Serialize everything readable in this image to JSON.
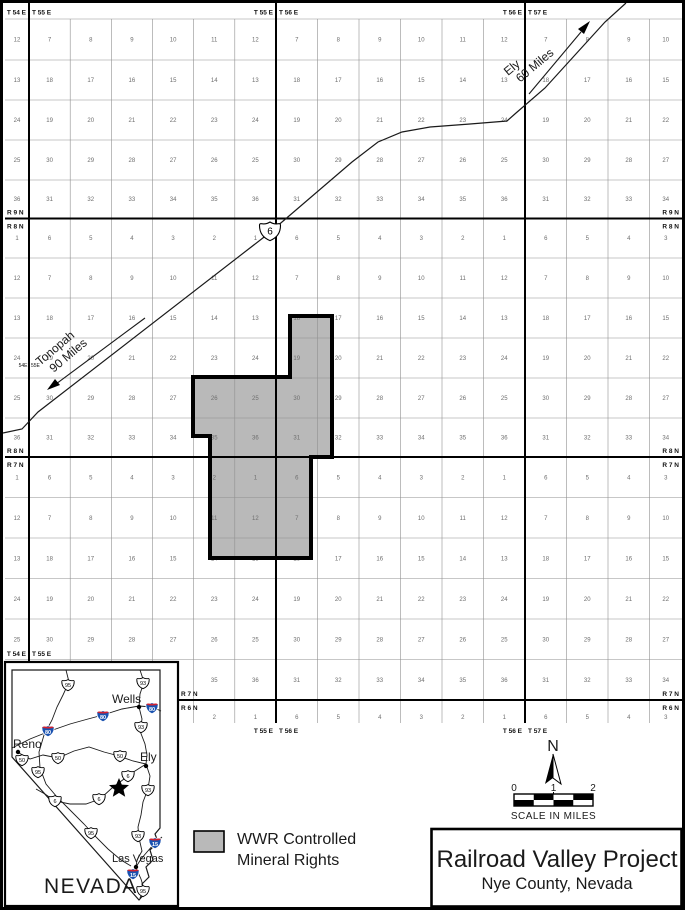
{
  "map": {
    "boundary_label_pairs": [
      [
        "T 54 E",
        "T 55 E"
      ],
      [
        "T 55 E",
        "T 56 E"
      ],
      [
        "T 56 E",
        "T 57 E"
      ]
    ],
    "mid_boundary_label": [
      "54E",
      "55E"
    ],
    "range_boundaries": [
      [
        "R 9 N",
        "R 8 N"
      ],
      [
        "R 8 N",
        "R 7 N"
      ],
      [
        "R 7 N",
        "R 6 N"
      ]
    ],
    "highway_shield": "6",
    "annotations": {
      "ely": {
        "line1": "Ely",
        "line2": "60 Miles"
      },
      "tonopah": {
        "line1": "Tonopah",
        "line2": "90 Miles"
      }
    },
    "bands": [
      {
        "name": "R9N",
        "rows": [
          [
            "12",
            "7",
            "8",
            "9",
            "10",
            "11",
            "12",
            "7",
            "8",
            "9",
            "10",
            "11",
            "12",
            "7",
            "8",
            "9",
            "10"
          ],
          [
            "13",
            "18",
            "17",
            "16",
            "15",
            "14",
            "13",
            "18",
            "17",
            "16",
            "15",
            "14",
            "13",
            "18",
            "17",
            "16",
            "15"
          ],
          [
            "24",
            "19",
            "20",
            "21",
            "22",
            "23",
            "24",
            "19",
            "20",
            "21",
            "22",
            "23",
            "24",
            "19",
            "20",
            "21",
            "22"
          ],
          [
            "25",
            "30",
            "29",
            "28",
            "27",
            "26",
            "25",
            "30",
            "29",
            "28",
            "27",
            "26",
            "25",
            "30",
            "29",
            "28",
            "27"
          ],
          [
            "36",
            "31",
            "32",
            "33",
            "34",
            "35",
            "36",
            "31",
            "32",
            "33",
            "34",
            "35",
            "36",
            "31",
            "32",
            "33",
            "34"
          ]
        ]
      },
      {
        "name": "R8N",
        "rows": [
          [
            "1",
            "6",
            "5",
            "4",
            "3",
            "2",
            "1",
            "6",
            "5",
            "4",
            "3",
            "2",
            "1",
            "6",
            "5",
            "4",
            "3"
          ],
          [
            "12",
            "7",
            "8",
            "9",
            "10",
            "11",
            "12",
            "7",
            "8",
            "9",
            "10",
            "11",
            "12",
            "7",
            "8",
            "9",
            "10"
          ],
          [
            "13",
            "18",
            "17",
            "16",
            "15",
            "14",
            "13",
            "18",
            "17",
            "16",
            "15",
            "14",
            "13",
            "18",
            "17",
            "16",
            "15"
          ],
          [
            "24",
            "19",
            "20",
            "21",
            "22",
            "23",
            "24",
            "19",
            "20",
            "21",
            "22",
            "23",
            "24",
            "19",
            "20",
            "21",
            "22"
          ],
          [
            "25",
            "30",
            "29",
            "28",
            "27",
            "26",
            "25",
            "30",
            "29",
            "28",
            "27",
            "26",
            "25",
            "30",
            "29",
            "28",
            "27"
          ],
          [
            "36",
            "31",
            "32",
            "33",
            "34",
            "35",
            "36",
            "31",
            "32",
            "33",
            "34",
            "35",
            "36",
            "31",
            "32",
            "33",
            "34"
          ]
        ]
      },
      {
        "name": "R7N",
        "rows": [
          [
            "1",
            "6",
            "5",
            "4",
            "3",
            "2",
            "1",
            "6",
            "5",
            "4",
            "3",
            "2",
            "1",
            "6",
            "5",
            "4",
            "3"
          ],
          [
            "12",
            "7",
            "8",
            "9",
            "10",
            "11",
            "12",
            "7",
            "8",
            "9",
            "10",
            "11",
            "12",
            "7",
            "8",
            "9",
            "10"
          ],
          [
            "13",
            "18",
            "17",
            "16",
            "15",
            "14",
            "13",
            "18",
            "17",
            "16",
            "15",
            "14",
            "13",
            "18",
            "17",
            "16",
            "15"
          ],
          [
            "24",
            "19",
            "20",
            "21",
            "22",
            "23",
            "24",
            "19",
            "20",
            "21",
            "22",
            "23",
            "24",
            "19",
            "20",
            "21",
            "22"
          ],
          [
            "25",
            "30",
            "29",
            "28",
            "27",
            "26",
            "25",
            "30",
            "29",
            "28",
            "27",
            "26",
            "25",
            "30",
            "29",
            "28",
            "27"
          ],
          [
            "36",
            "31",
            "32",
            "33",
            "34",
            "35",
            "36",
            "31",
            "32",
            "33",
            "34",
            "35",
            "36",
            "31",
            "32",
            "33",
            "34"
          ]
        ]
      },
      {
        "name": "R6N",
        "rows": [
          [
            "1",
            "6",
            "5",
            "4",
            "3",
            "2",
            "1",
            "6",
            "5",
            "4",
            "3",
            "2",
            "1",
            "6",
            "5",
            "4",
            "3"
          ]
        ]
      }
    ]
  },
  "inset": {
    "state_label": "NEVADA",
    "cities": [
      {
        "name": "Reno"
      },
      {
        "name": "Wells"
      },
      {
        "name": "Ely"
      },
      {
        "name": "Las Vegas"
      }
    ],
    "shields": [
      {
        "t": "us",
        "n": "95",
        "x": 68,
        "y": 685
      },
      {
        "t": "us",
        "n": "93",
        "x": 143,
        "y": 683
      },
      {
        "t": "i",
        "n": "80",
        "x": 152,
        "y": 708
      },
      {
        "t": "i",
        "n": "80",
        "x": 103,
        "y": 716
      },
      {
        "t": "i",
        "n": "80",
        "x": 48,
        "y": 731
      },
      {
        "t": "us",
        "n": "93",
        "x": 141,
        "y": 727
      },
      {
        "t": "us",
        "n": "50",
        "x": 22,
        "y": 760
      },
      {
        "t": "us",
        "n": "50",
        "x": 58,
        "y": 758
      },
      {
        "t": "us",
        "n": "50",
        "x": 120,
        "y": 756
      },
      {
        "t": "us",
        "n": "95",
        "x": 38,
        "y": 772
      },
      {
        "t": "us",
        "n": "6",
        "x": 128,
        "y": 776
      },
      {
        "t": "us",
        "n": "93",
        "x": 148,
        "y": 790
      },
      {
        "t": "us",
        "n": "6",
        "x": 99,
        "y": 799
      },
      {
        "t": "us",
        "n": "6",
        "x": 55,
        "y": 801
      },
      {
        "t": "us",
        "n": "95",
        "x": 91,
        "y": 833
      },
      {
        "t": "us",
        "n": "93",
        "x": 138,
        "y": 836
      },
      {
        "t": "i",
        "n": "15",
        "x": 155,
        "y": 843
      },
      {
        "t": "i",
        "n": "15",
        "x": 133,
        "y": 874
      },
      {
        "t": "us",
        "n": "95",
        "x": 143,
        "y": 891
      }
    ]
  },
  "legend": {
    "line1": "WWR Controlled",
    "line2": "Mineral Rights",
    "swatch_color": "#b9b9b9"
  },
  "north": {
    "label": "N"
  },
  "scale": {
    "ticks": [
      "0",
      "1",
      "2"
    ],
    "caption": "SCALE IN MILES"
  },
  "title": {
    "line1": "Railroad Valley Project",
    "line2": "Nye County, Nevada"
  }
}
